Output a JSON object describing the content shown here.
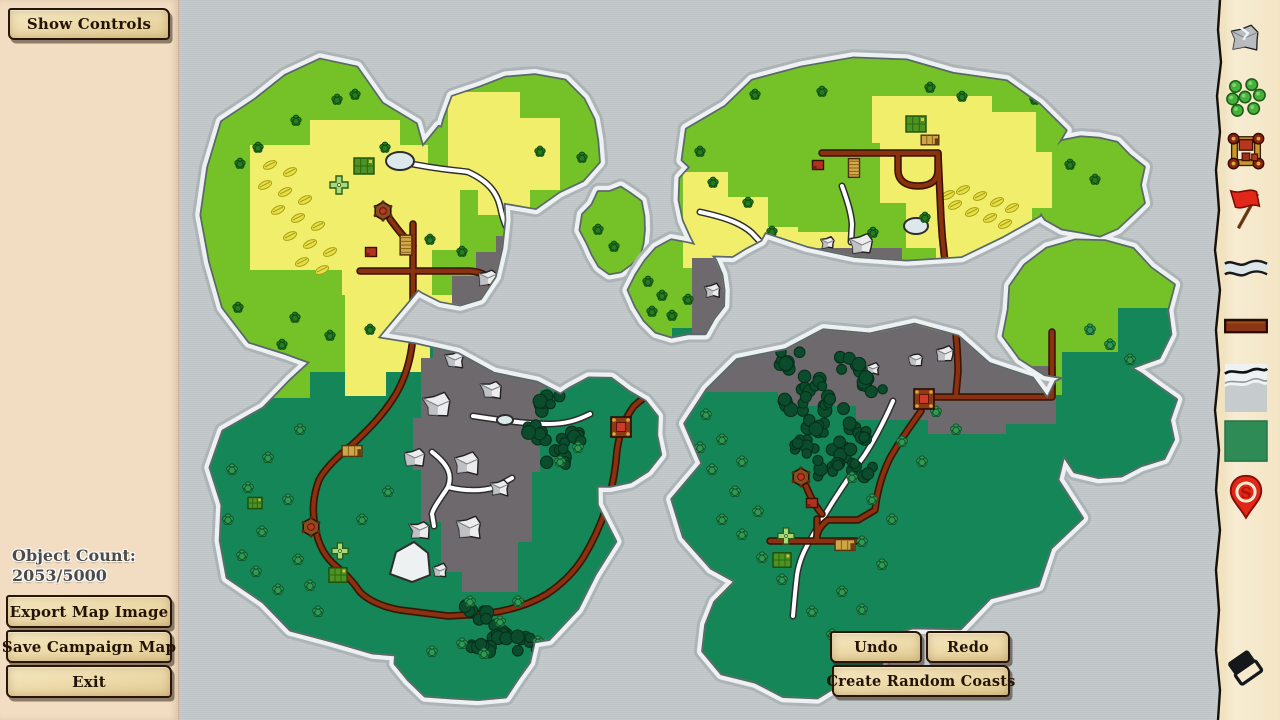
{
  "app": {
    "title": "Campaign Map Editor"
  },
  "left_panel": {
    "show_controls": "Show Controls",
    "object_count_label": "Object Count:",
    "object_count_value": "2053/5000",
    "export_button": "Export Map Image",
    "save_button": "Save Campaign Map",
    "exit_button": "Exit"
  },
  "map_actions": {
    "undo": "Undo",
    "redo": "Redo",
    "create_random_coasts": "Create Random Coasts"
  },
  "toolbar": {
    "tools": [
      {
        "id": "rock",
        "icon": "rock-icon"
      },
      {
        "id": "trees",
        "icon": "trees-icon"
      },
      {
        "id": "building",
        "icon": "building-icon"
      },
      {
        "id": "flag",
        "icon": "flag-icon"
      },
      {
        "id": "river",
        "icon": "river-icon"
      },
      {
        "id": "road",
        "icon": "road-icon"
      },
      {
        "id": "coast",
        "icon": "coast-icon"
      },
      {
        "id": "terrain",
        "icon": "green-terrain-icon"
      },
      {
        "id": "marker",
        "icon": "location-pin-icon"
      },
      {
        "id": "eraser",
        "icon": "eraser-icon"
      }
    ]
  },
  "palette": {
    "water": "#c3c8ca",
    "coastOuter": "#adb4b8",
    "coastHalo": "#eef1f2",
    "landEdge": "#5b676d",
    "lightGreen": "#74c128",
    "darkGreen": "#148658",
    "yellow": "#f1ee6b",
    "mountainGray": "#6e696d",
    "rockFill": "#ececee",
    "rockShade": "#b7babd",
    "rockStroke": "#212121",
    "roadFill": "#8a3210",
    "roadEdge": "#3d1404",
    "riverEdge": "#2d2d2d",
    "river": "#ffffff",
    "pineFill": "#267a1f",
    "pineEdge": "#0f4d12",
    "bushFill": "#2f9a52",
    "bushEdge": "#11552c",
    "forestFill": "#0b4c2c",
    "forestEdge": "#05301b",
    "hayFill": "#e8e049",
    "hayStroke": "#a9a012",
    "parchment": "#f6ead0",
    "panelCream": "#f2ddc2",
    "accentRed": "#e02718"
  }
}
